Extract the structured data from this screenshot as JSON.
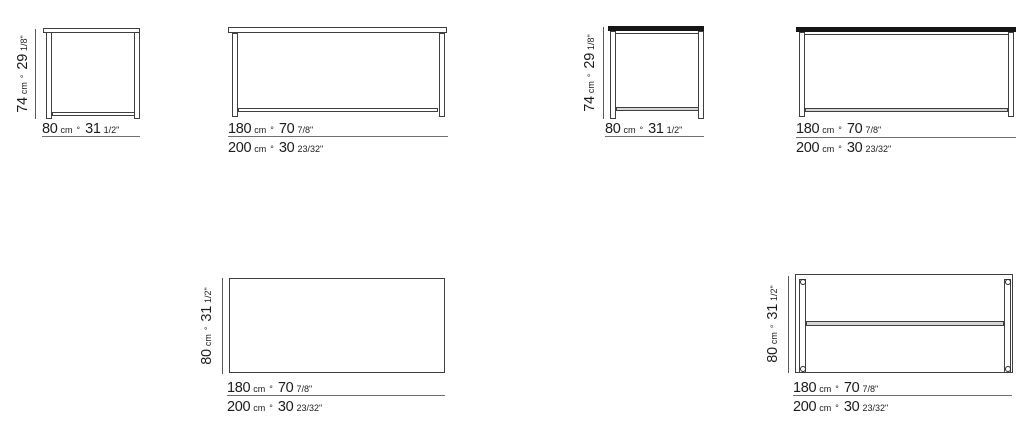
{
  "colors": {
    "line": "#3f3f3f",
    "text": "#1c1c1c",
    "tabletop_fill": "#161616",
    "dimension_rule": "#6f6f6f",
    "stretcher_fill": "#d6d6d6"
  },
  "dims": {
    "d74": {
      "v1": "74",
      "u1": "cm",
      "sep": "°",
      "v2": "29",
      "f2": "1/8\""
    },
    "d80": {
      "v1": "80",
      "u1": "cm",
      "sep": "°",
      "v2": "31",
      "f2": "1/2\""
    },
    "d180": {
      "v1": "180",
      "u1": "cm",
      "sep": "°",
      "v2": "70",
      "f2": "7/8\""
    },
    "d200": {
      "v1": "200",
      "u1": "cm",
      "sep": "°",
      "v2": "30",
      "f2": "23/32\""
    }
  },
  "figures": [
    {
      "name": "table-elevation-side-model-1",
      "height_dim": "74 cm ° 29 1/8\"",
      "width_dim": "80 cm ° 31 1/2\""
    },
    {
      "name": "table-elevation-front-model-1",
      "width_dims": [
        "180 cm ° 70 7/8\"",
        "200 cm ° 30 23/32\""
      ]
    },
    {
      "name": "table-elevation-side-model-2",
      "height_dim": "74 cm ° 29 1/8\"",
      "width_dim": "80 cm ° 31 1/2\""
    },
    {
      "name": "table-elevation-front-model-2",
      "width_dims": [
        "180 cm ° 70 7/8\"",
        "200 cm ° 30 23/32\""
      ]
    },
    {
      "name": "tabletop-plan-view-model-1",
      "depth_dim": "80 cm ° 31 1/2\"",
      "width_dims": [
        "180 cm ° 70 7/8\"",
        "200 cm ° 30 23/32\""
      ]
    },
    {
      "name": "tabletop-plan-view-model-2",
      "depth_dim": "80 cm ° 31 1/2\"",
      "width_dims": [
        "180 cm ° 70 7/8\"",
        "200 cm ° 30 23/32\""
      ]
    }
  ]
}
